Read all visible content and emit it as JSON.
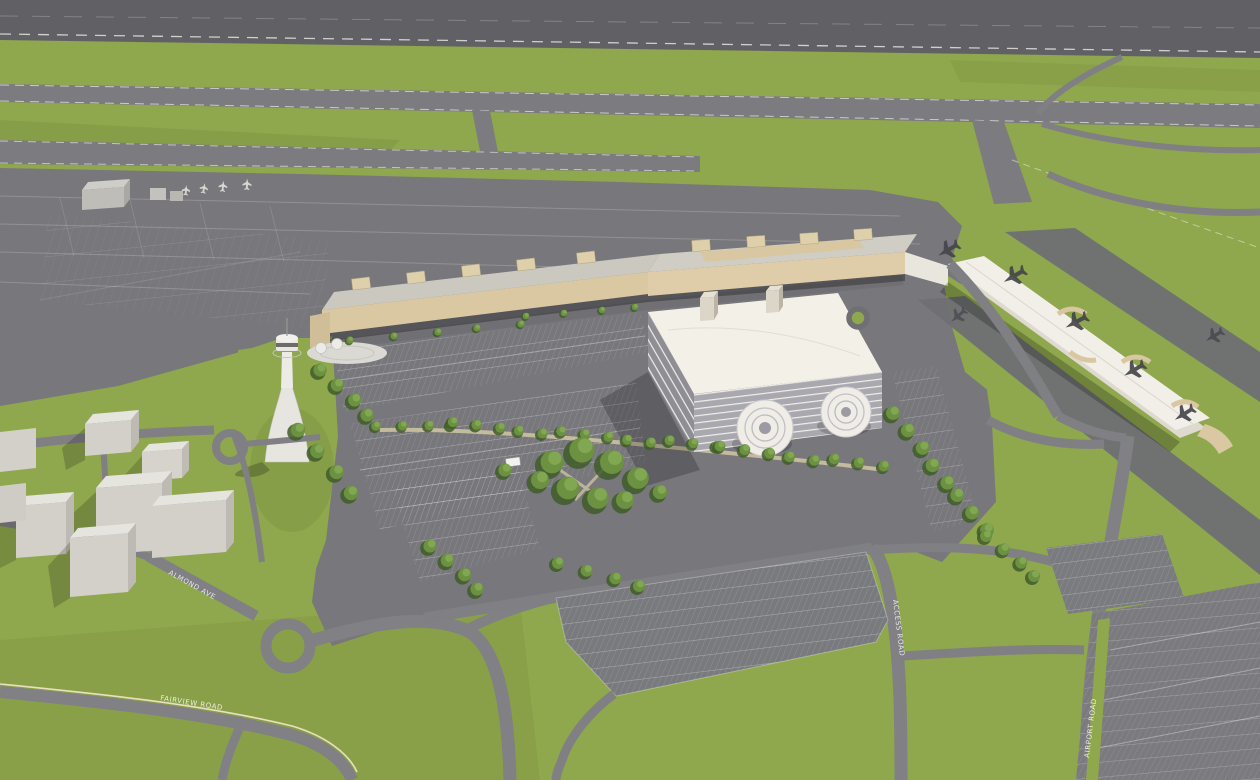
{
  "scene": {
    "title": "Airport campus aerial rendering",
    "view": "oblique bird's-eye 3D architectural rendering",
    "description": "Runways and taxiways across the top, tan passenger terminal with gate stubs, white concourse pier with parked aircraft, large white parking garage with twin spiral ramps, air traffic control tower, tree-lined parking lots, loop roads and outlying surface lots on green grass."
  },
  "road_labels": {
    "almond": "ALMOND AVE",
    "fairview": "FAIRVIEW ROAD",
    "access": "ACCESS ROAD",
    "airport": "AIRPORT ROAD"
  },
  "features": {
    "airfield": [
      "main-runway",
      "parallel-taxiways",
      "taxiway-connectors",
      "aircraft-apron",
      "general-aviation-area"
    ],
    "buildings": [
      "passenger-terminal",
      "concourse-pier",
      "parking-garage",
      "spiral-parking-ramps",
      "air-traffic-control-tower",
      "support-buildings"
    ],
    "landside": [
      "short-term-parking-lots",
      "overflow-parking-lot",
      "remote-parking-lot",
      "tree-lined-pedestrian-walkway",
      "central-tree-grove",
      "terminal-loop-road",
      "teardrop-cul-de-sac"
    ]
  },
  "palette": {
    "grass": "#8FA74D",
    "runway": "#616165",
    "taxiway": "#7B7B80",
    "apron": "#77777C",
    "road": "#7F7F84",
    "parking_lot": "#797A7E",
    "terminal_tan": "#D9C8A2",
    "roof_gray": "#CBC8BF",
    "garage_white": "#F3F0E8",
    "pier_white": "#EDEAE1",
    "building_gray": "#D6D3CC",
    "tree_green": "#6C9140",
    "marking_white": "#FFFFFF"
  }
}
